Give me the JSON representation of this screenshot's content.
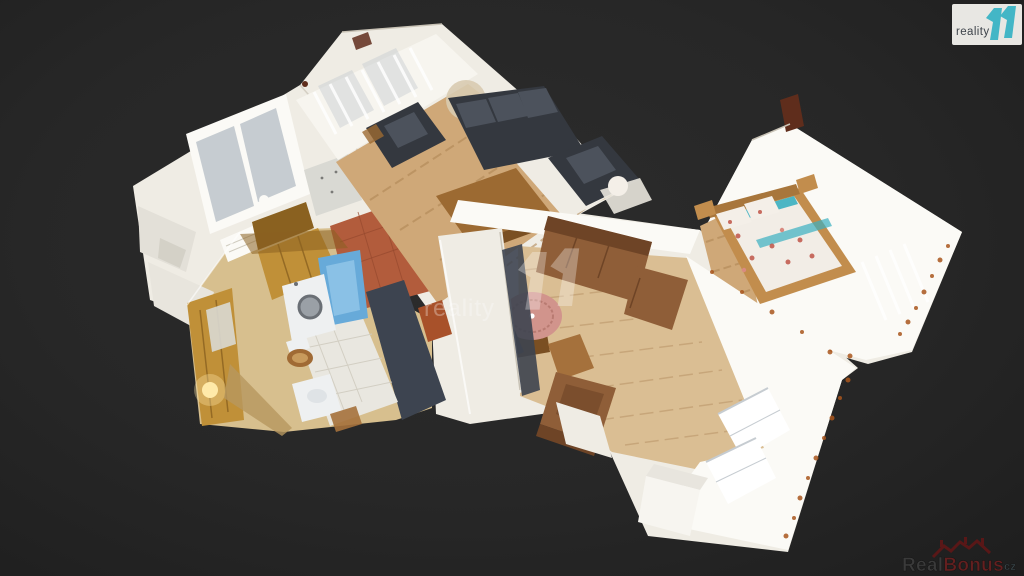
{
  "branding": {
    "corner_logo": {
      "text": "reality",
      "mark": "11",
      "box_color": "#e8e7e3",
      "text_color": "#3d434a",
      "mark_color": "#43b6c6"
    },
    "center_watermark": {
      "text": "reality",
      "mark": "11",
      "color": "#ffffff"
    },
    "bottom_watermark": {
      "prefix": "Real",
      "accent": "Bonus",
      "suffix": "cz",
      "prefix_color": "#3d3d3d",
      "accent_color": "#6a1f1f",
      "suffix_color": "#3e4d52",
      "icon": "houses-roofline-icon",
      "icon_color": "#5e1717"
    }
  },
  "scene": {
    "type": "3d-dollhouse-floorplan",
    "description": "Overhead dollhouse 3D scan of a furnished apartment viewed at an angle on a dark background",
    "rooms": [
      {
        "name": "kitchen",
        "features": [
          "window",
          "golden-cabinets",
          "speckled-counter",
          "terracotta-tile-floor",
          "radiator"
        ]
      },
      {
        "name": "living-room",
        "features": [
          "lace-curtain-windows",
          "black-leather-sofa-set",
          "wood-coffee-table",
          "light-wood-floor",
          "dried-flower-decor"
        ]
      },
      {
        "name": "bathroom",
        "features": [
          "blue-bathtub",
          "washing-machine",
          "wooden-seat-toilet",
          "white-sink",
          "tan-tile-walls",
          "gold-wall-with-lamp",
          "white-tile-floor"
        ]
      },
      {
        "name": "hallway",
        "features": [
          "dark-carpet",
          "white-partition-wall"
        ]
      },
      {
        "name": "dining-room",
        "features": [
          "parquet-floor",
          "brown-tufted-sofa",
          "round-table-pink-cloth",
          "wooden-chairs",
          "white-cabinet",
          "curtained-windows"
        ]
      },
      {
        "name": "bedroom",
        "features": [
          "double-bed-floral-bedding",
          "teal-accents",
          "wood-headboard",
          "bright-white-walls",
          "curtains-with-rust-stains"
        ]
      }
    ],
    "palette": {
      "background": "#262626",
      "wall": "#efece4",
      "wall_bright": "#fbfaf6",
      "wall_shadow": "#c9c3b6",
      "curtain": "#f7f5ef",
      "glass": "#c6ccd1",
      "wood": "#cfa878",
      "wood_dark": "#b08756",
      "parquet": "#dabe93",
      "parquet_dark": "#c3a175",
      "terracotta": "#b25c3c",
      "terracotta_dark": "#96492e",
      "tan": "#d7bf8e",
      "tan_dark": "#b6975f",
      "gold": "#c09038",
      "gold_dark": "#8a6120",
      "tile": "#e9e7e0",
      "tile_line": "#d0ccc0",
      "counter": "#d9d9d3",
      "sofa_dark": "#34383f",
      "sofa_dark_hi": "#4c525c",
      "sofa_brown": "#8f5e38",
      "sofa_brown_dark": "#6e4426",
      "wood_furn": "#9c6a32",
      "wood_furn_dark": "#7a4f22",
      "chair_wood": "#a5713c",
      "chair_dark": "#4a433e",
      "cloth": "#d1948c",
      "cloth_dark": "#b97b72",
      "carpet": "#3d4450",
      "tub": "#67aad9",
      "tub_hi": "#93c7e8",
      "appliance": "#eef0f1",
      "steel": "#9aa0a6",
      "bed_wood": "#c28d4d",
      "bed_wood_dark": "#a8763c",
      "duvet": "#f2ede6",
      "floral": "#c05548",
      "floral_soft": "#d98a80",
      "teal": "#3aafc0",
      "rust": "#a9561d",
      "artifact_red": "#5f2d1c",
      "orange_item": "#a8512a",
      "lamp": "#ffe9a8",
      "pillow": "#f4efe8",
      "blanket": "#e9e6dd",
      "box_white": "#f7f5f0",
      "box_top": "#e8e5de",
      "seat_wood": "#a06a34",
      "seat_wood_hi": "#c89a5c",
      "plant": "#d8cbb0"
    }
  }
}
